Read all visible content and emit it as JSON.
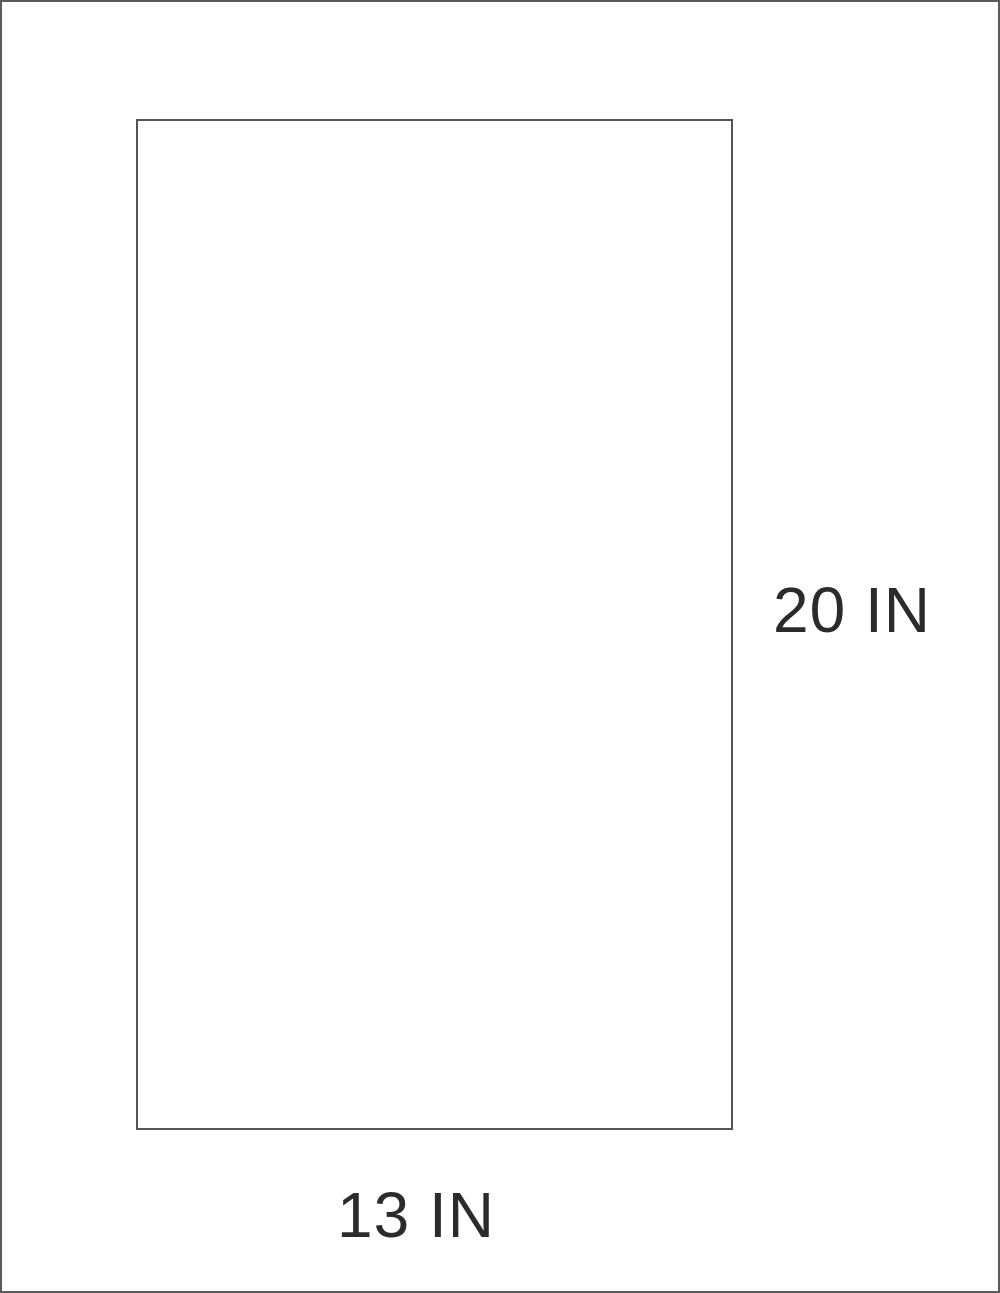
{
  "diagram": {
    "type": "dimension-diagram",
    "shape": "rectangle",
    "height_label": "20 IN",
    "width_label": "13 IN",
    "height_value": 20,
    "width_value": 13,
    "unit": "IN",
    "colors": {
      "background": "#ffffff",
      "line": "#555555",
      "text": "#2b2b2b"
    }
  }
}
